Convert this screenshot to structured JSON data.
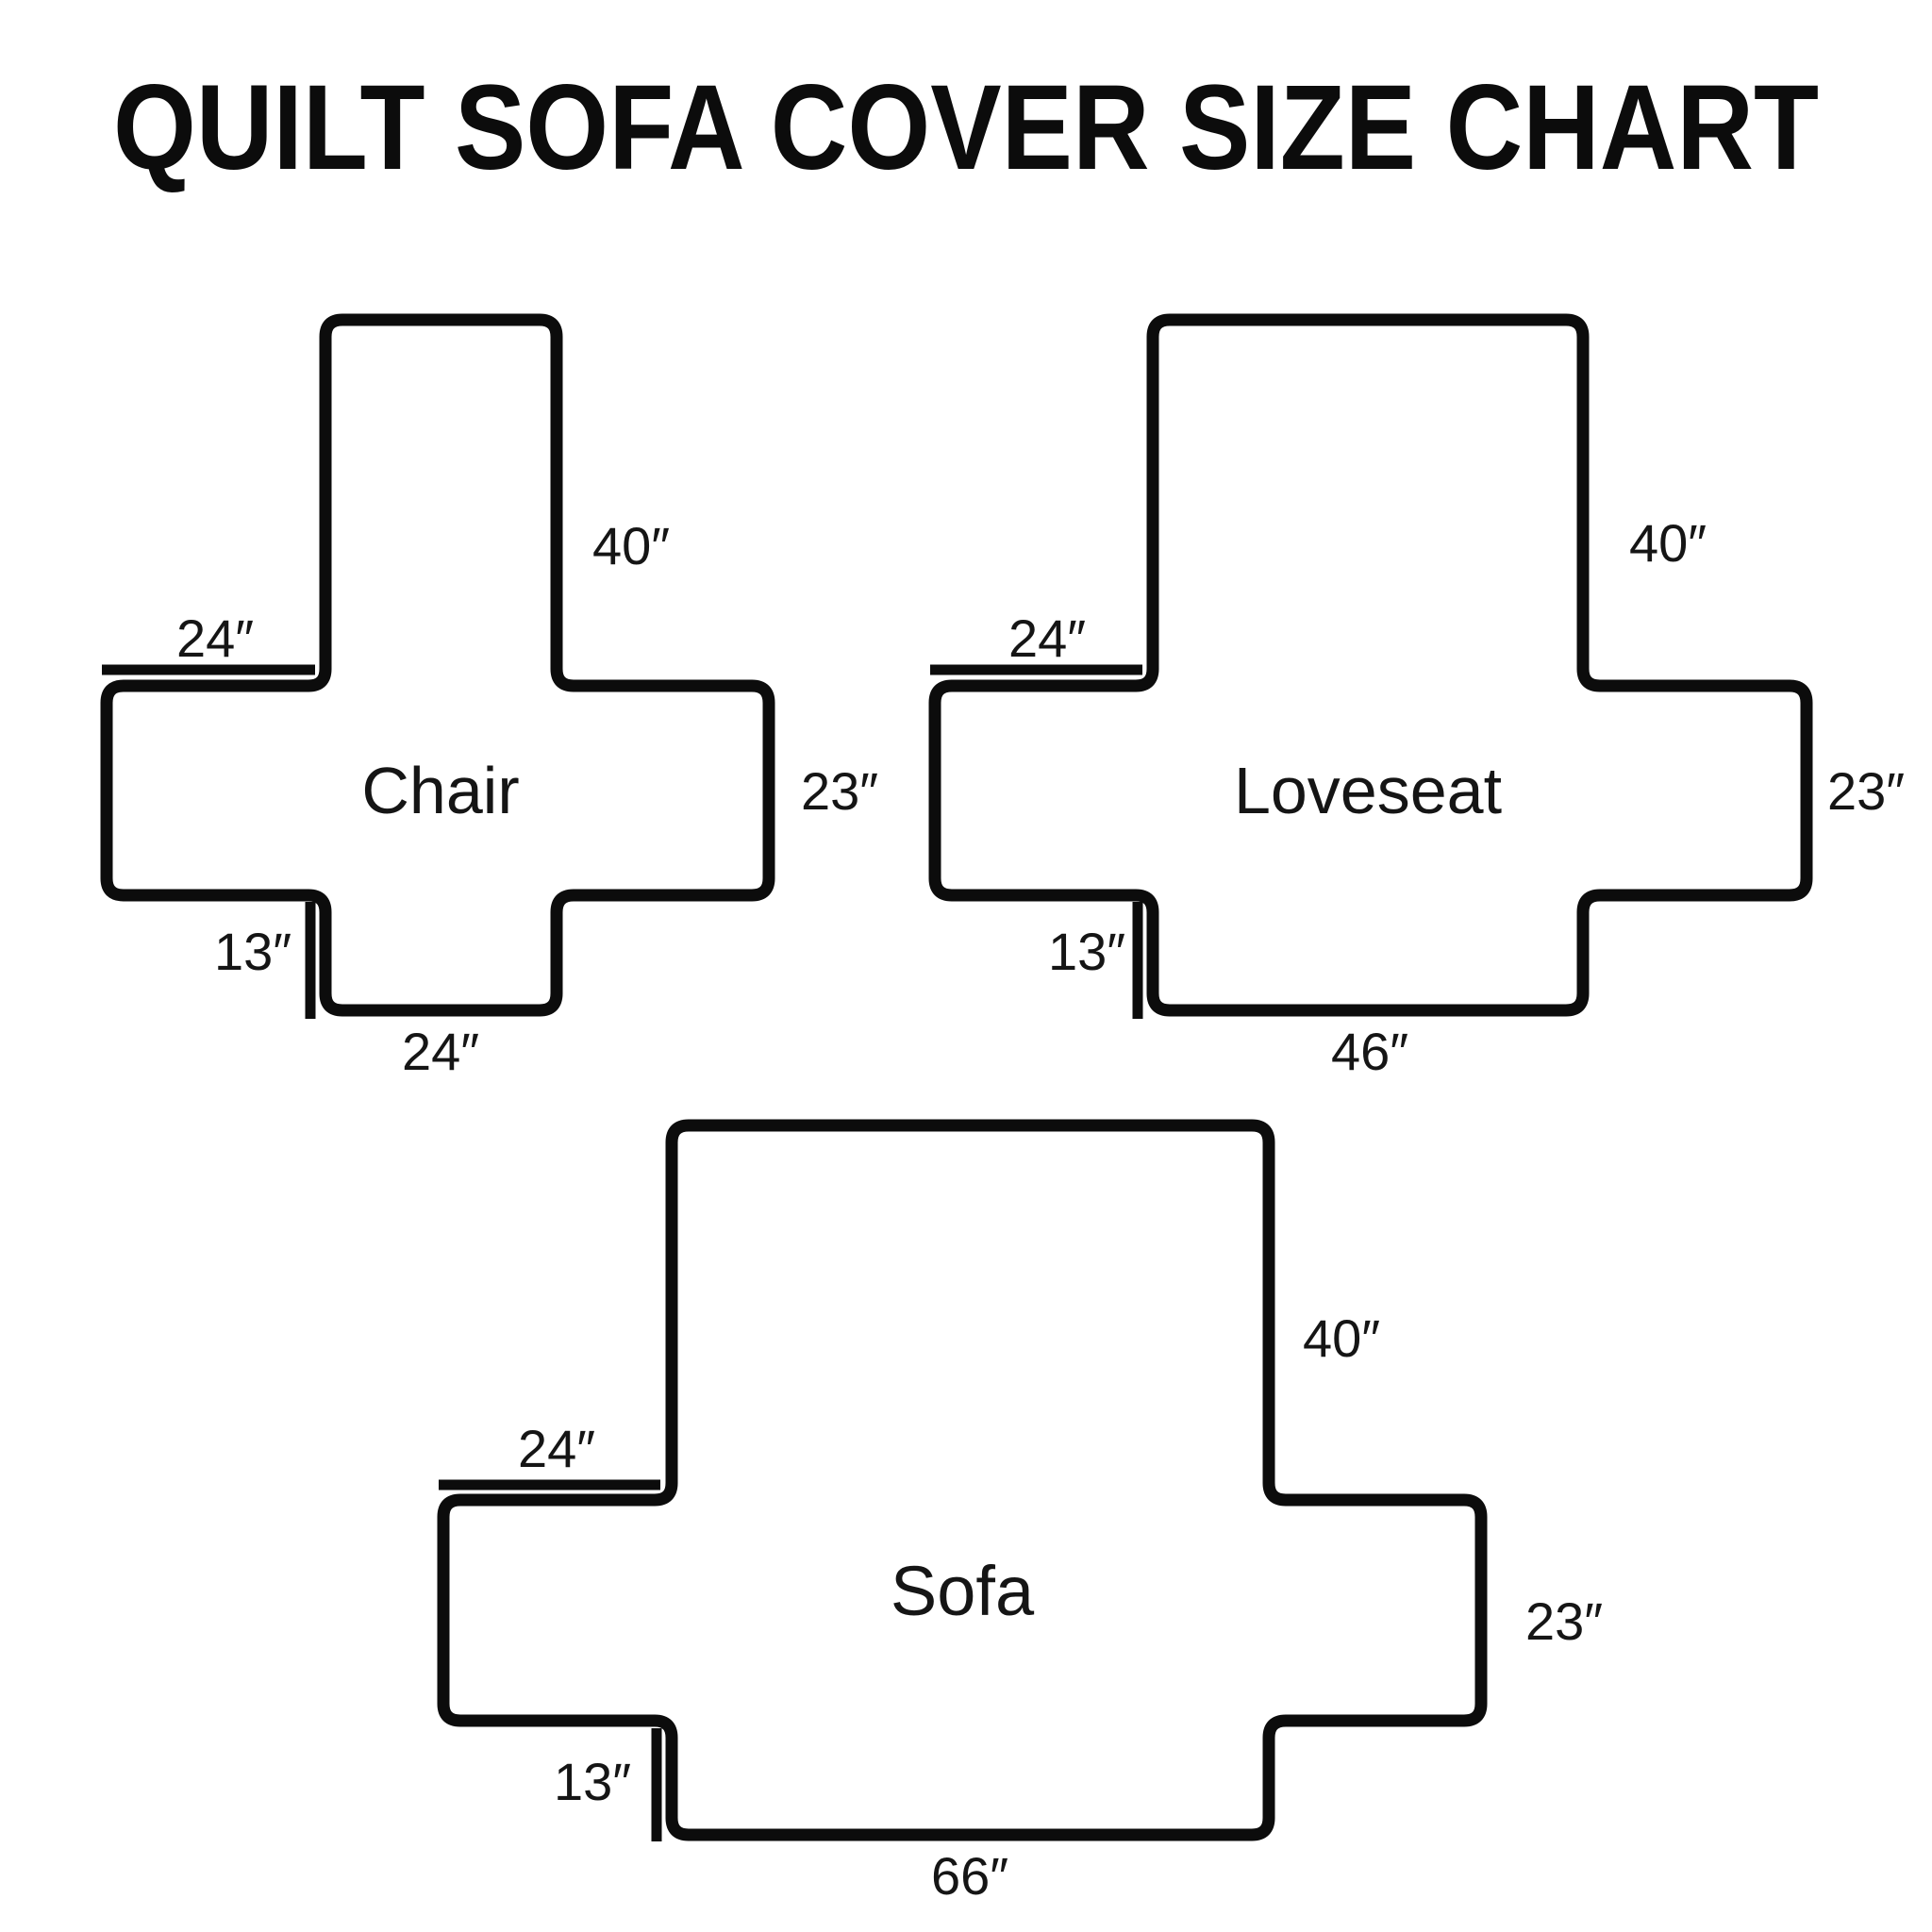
{
  "title": "QUILT SOFA COVER SIZE CHART",
  "colors": {
    "ink": "#0c0c0c",
    "background": "#ffffff"
  },
  "diagrams": [
    {
      "name": "Chair",
      "back_height": "40″",
      "arm_top_width": "24″",
      "arm_side_height": "23″",
      "front_drop": "13″",
      "bottom_width": "24″"
    },
    {
      "name": "Loveseat",
      "back_height": "40″",
      "arm_top_width": "24″",
      "arm_side_height": "23″",
      "front_drop": "13″",
      "bottom_width": "46″"
    },
    {
      "name": "Sofa",
      "back_height": "40″",
      "arm_top_width": "24″",
      "arm_side_height": "23″",
      "front_drop": "13″",
      "bottom_width": "66″"
    }
  ]
}
